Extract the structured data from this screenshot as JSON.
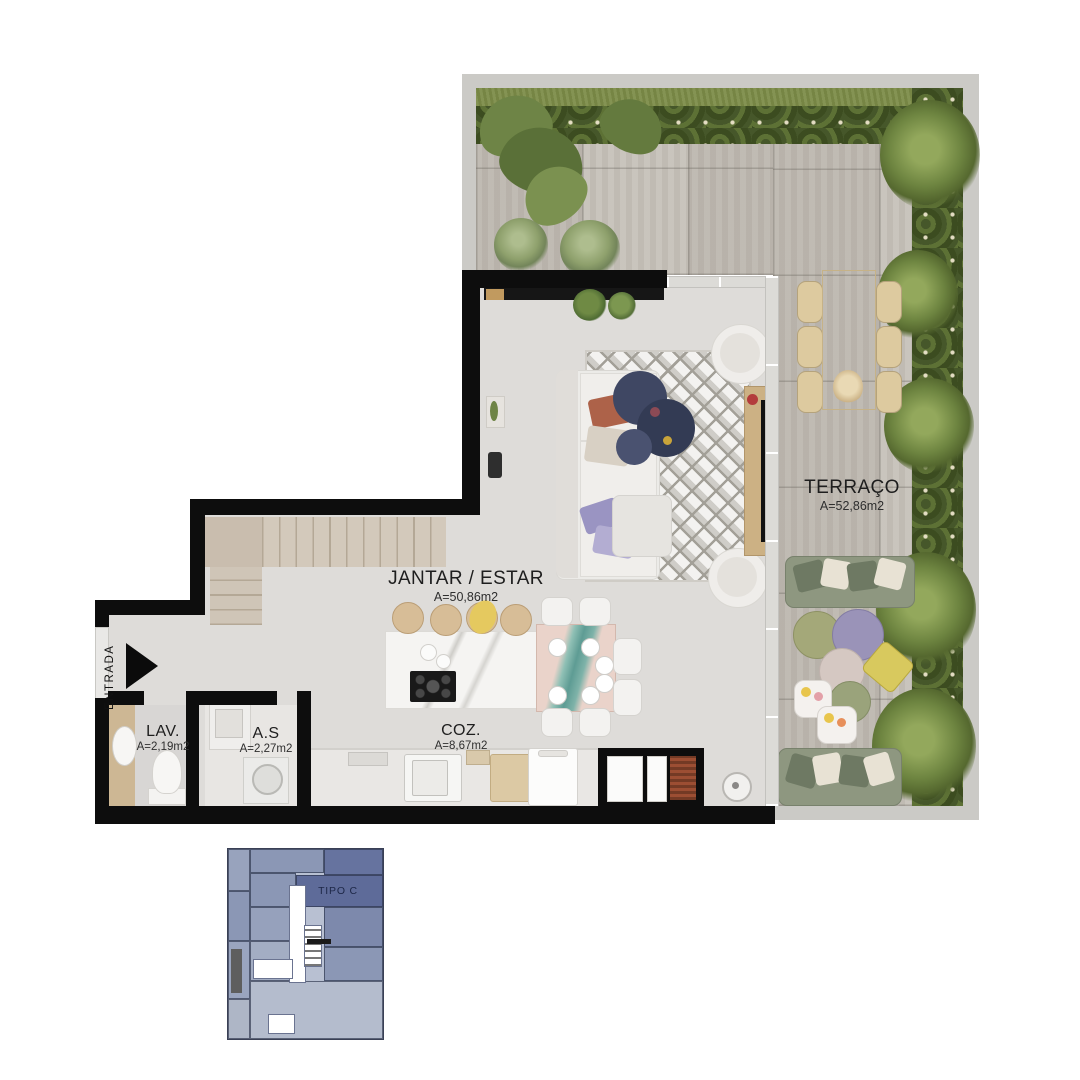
{
  "plan": {
    "rooms": [
      {
        "id": "terraco",
        "name": "TERRAÇO",
        "area": "A=52,86m2"
      },
      {
        "id": "jantar_estar",
        "name": "JANTAR / ESTAR",
        "area": "A=50,86m2"
      },
      {
        "id": "lav",
        "name": "LAV.",
        "area": "A=2,19m2"
      },
      {
        "id": "as",
        "name": "A.S",
        "area": "A=2,27m2"
      },
      {
        "id": "coz",
        "name": "COZ.",
        "area": "A=8,67m2"
      }
    ],
    "entrance_label": "ENTRADA",
    "colors": {
      "wall": "#0d0d0d",
      "terrace_tile": "#c6c1b9",
      "interior_floor": "#dedcd9",
      "hedge_green": "#4e5f2c",
      "sofa_green": "#8e9780",
      "accent_yellow": "#d8c95e",
      "accent_lavender": "#9a93b8",
      "accent_navy": "#3a4258"
    }
  },
  "keyplan": {
    "label": "TIPO C",
    "highlight_color": "#5e6b99"
  }
}
